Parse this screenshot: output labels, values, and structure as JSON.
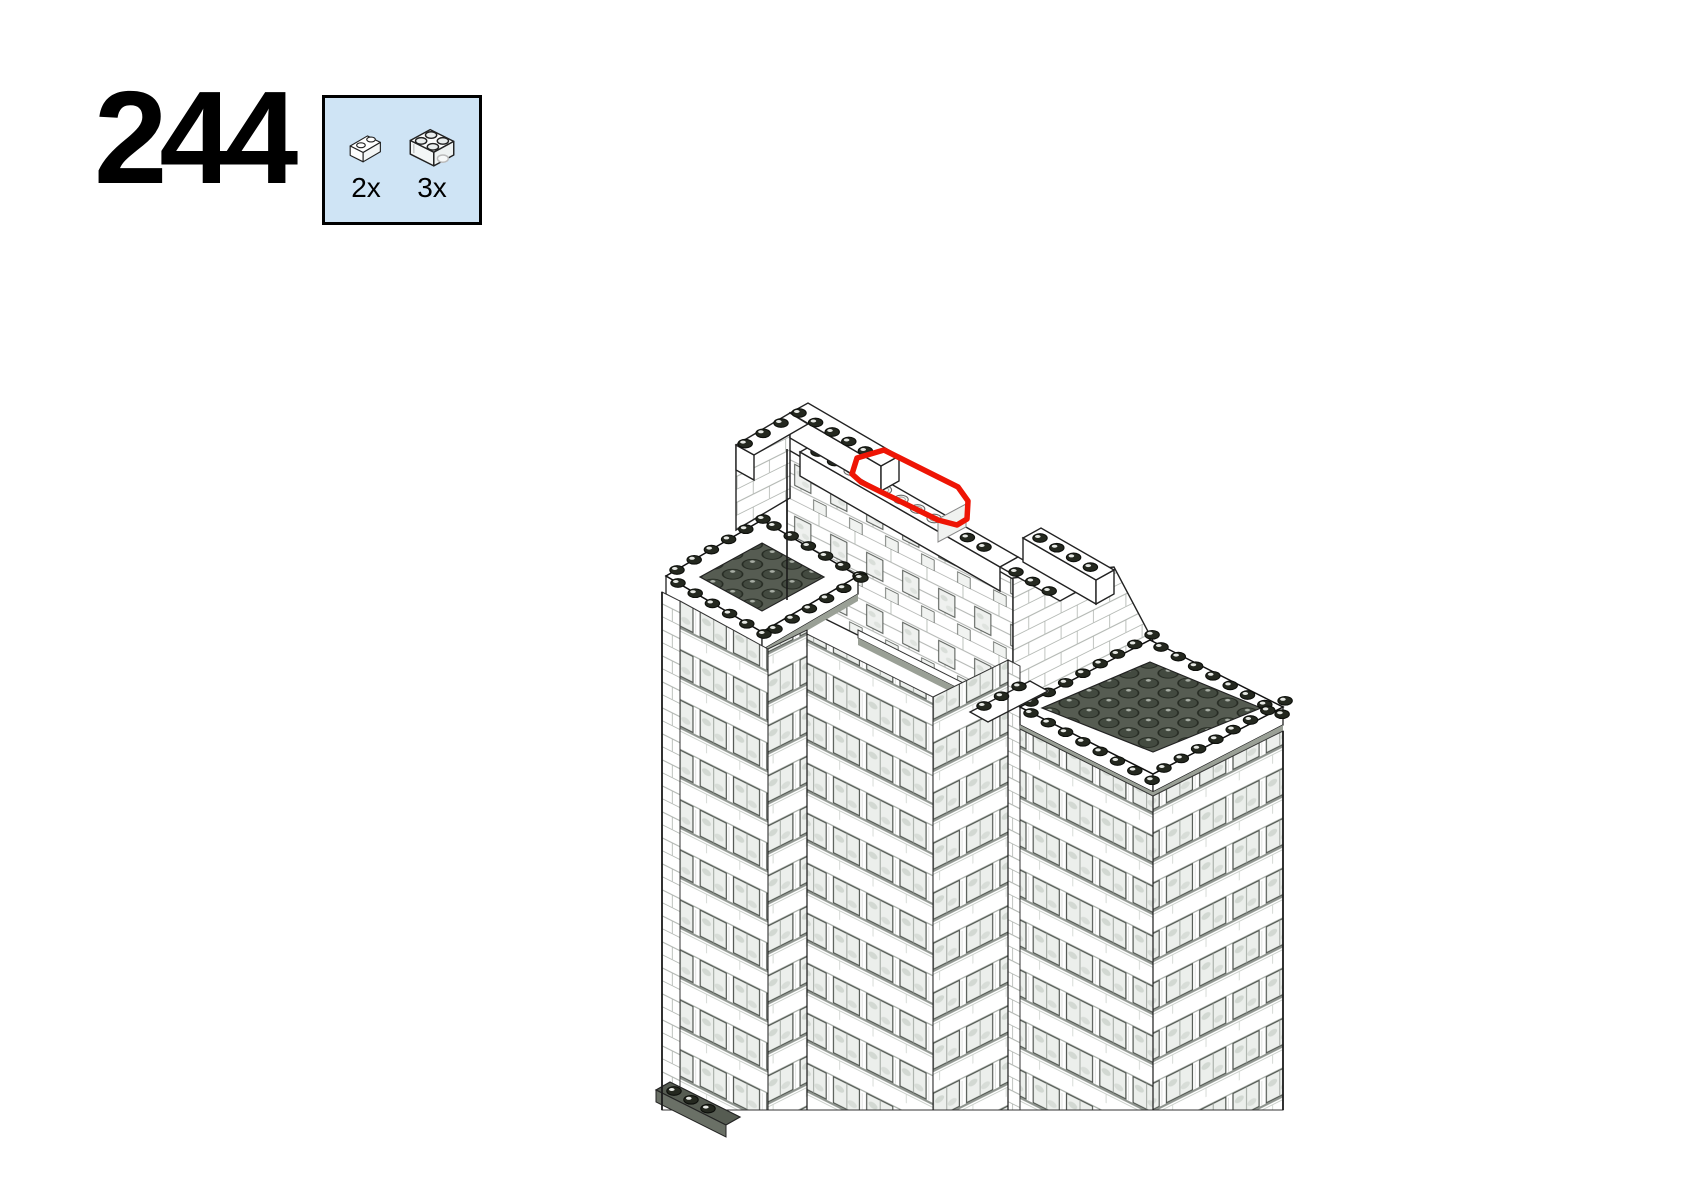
{
  "step": {
    "number": "244"
  },
  "parts_callout": {
    "background": "#cfe4f5",
    "border_color": "#000000",
    "parts": [
      {
        "name": "brick-1x2-transparent",
        "count_label": "2x"
      },
      {
        "name": "brick-2x2-transparent",
        "count_label": "3x"
      }
    ]
  },
  "illustration": {
    "description": "Isometric LEGO skyscraper model showing placement of transparent bricks on the top parapet wall",
    "highlight_color": "#ee1505",
    "colors": {
      "roof_plate": "#565c52",
      "stud_dark": "#24281f",
      "ledge": "#9aa096",
      "window_glass": "#ecefec",
      "line": "#1a1a1a"
    }
  }
}
